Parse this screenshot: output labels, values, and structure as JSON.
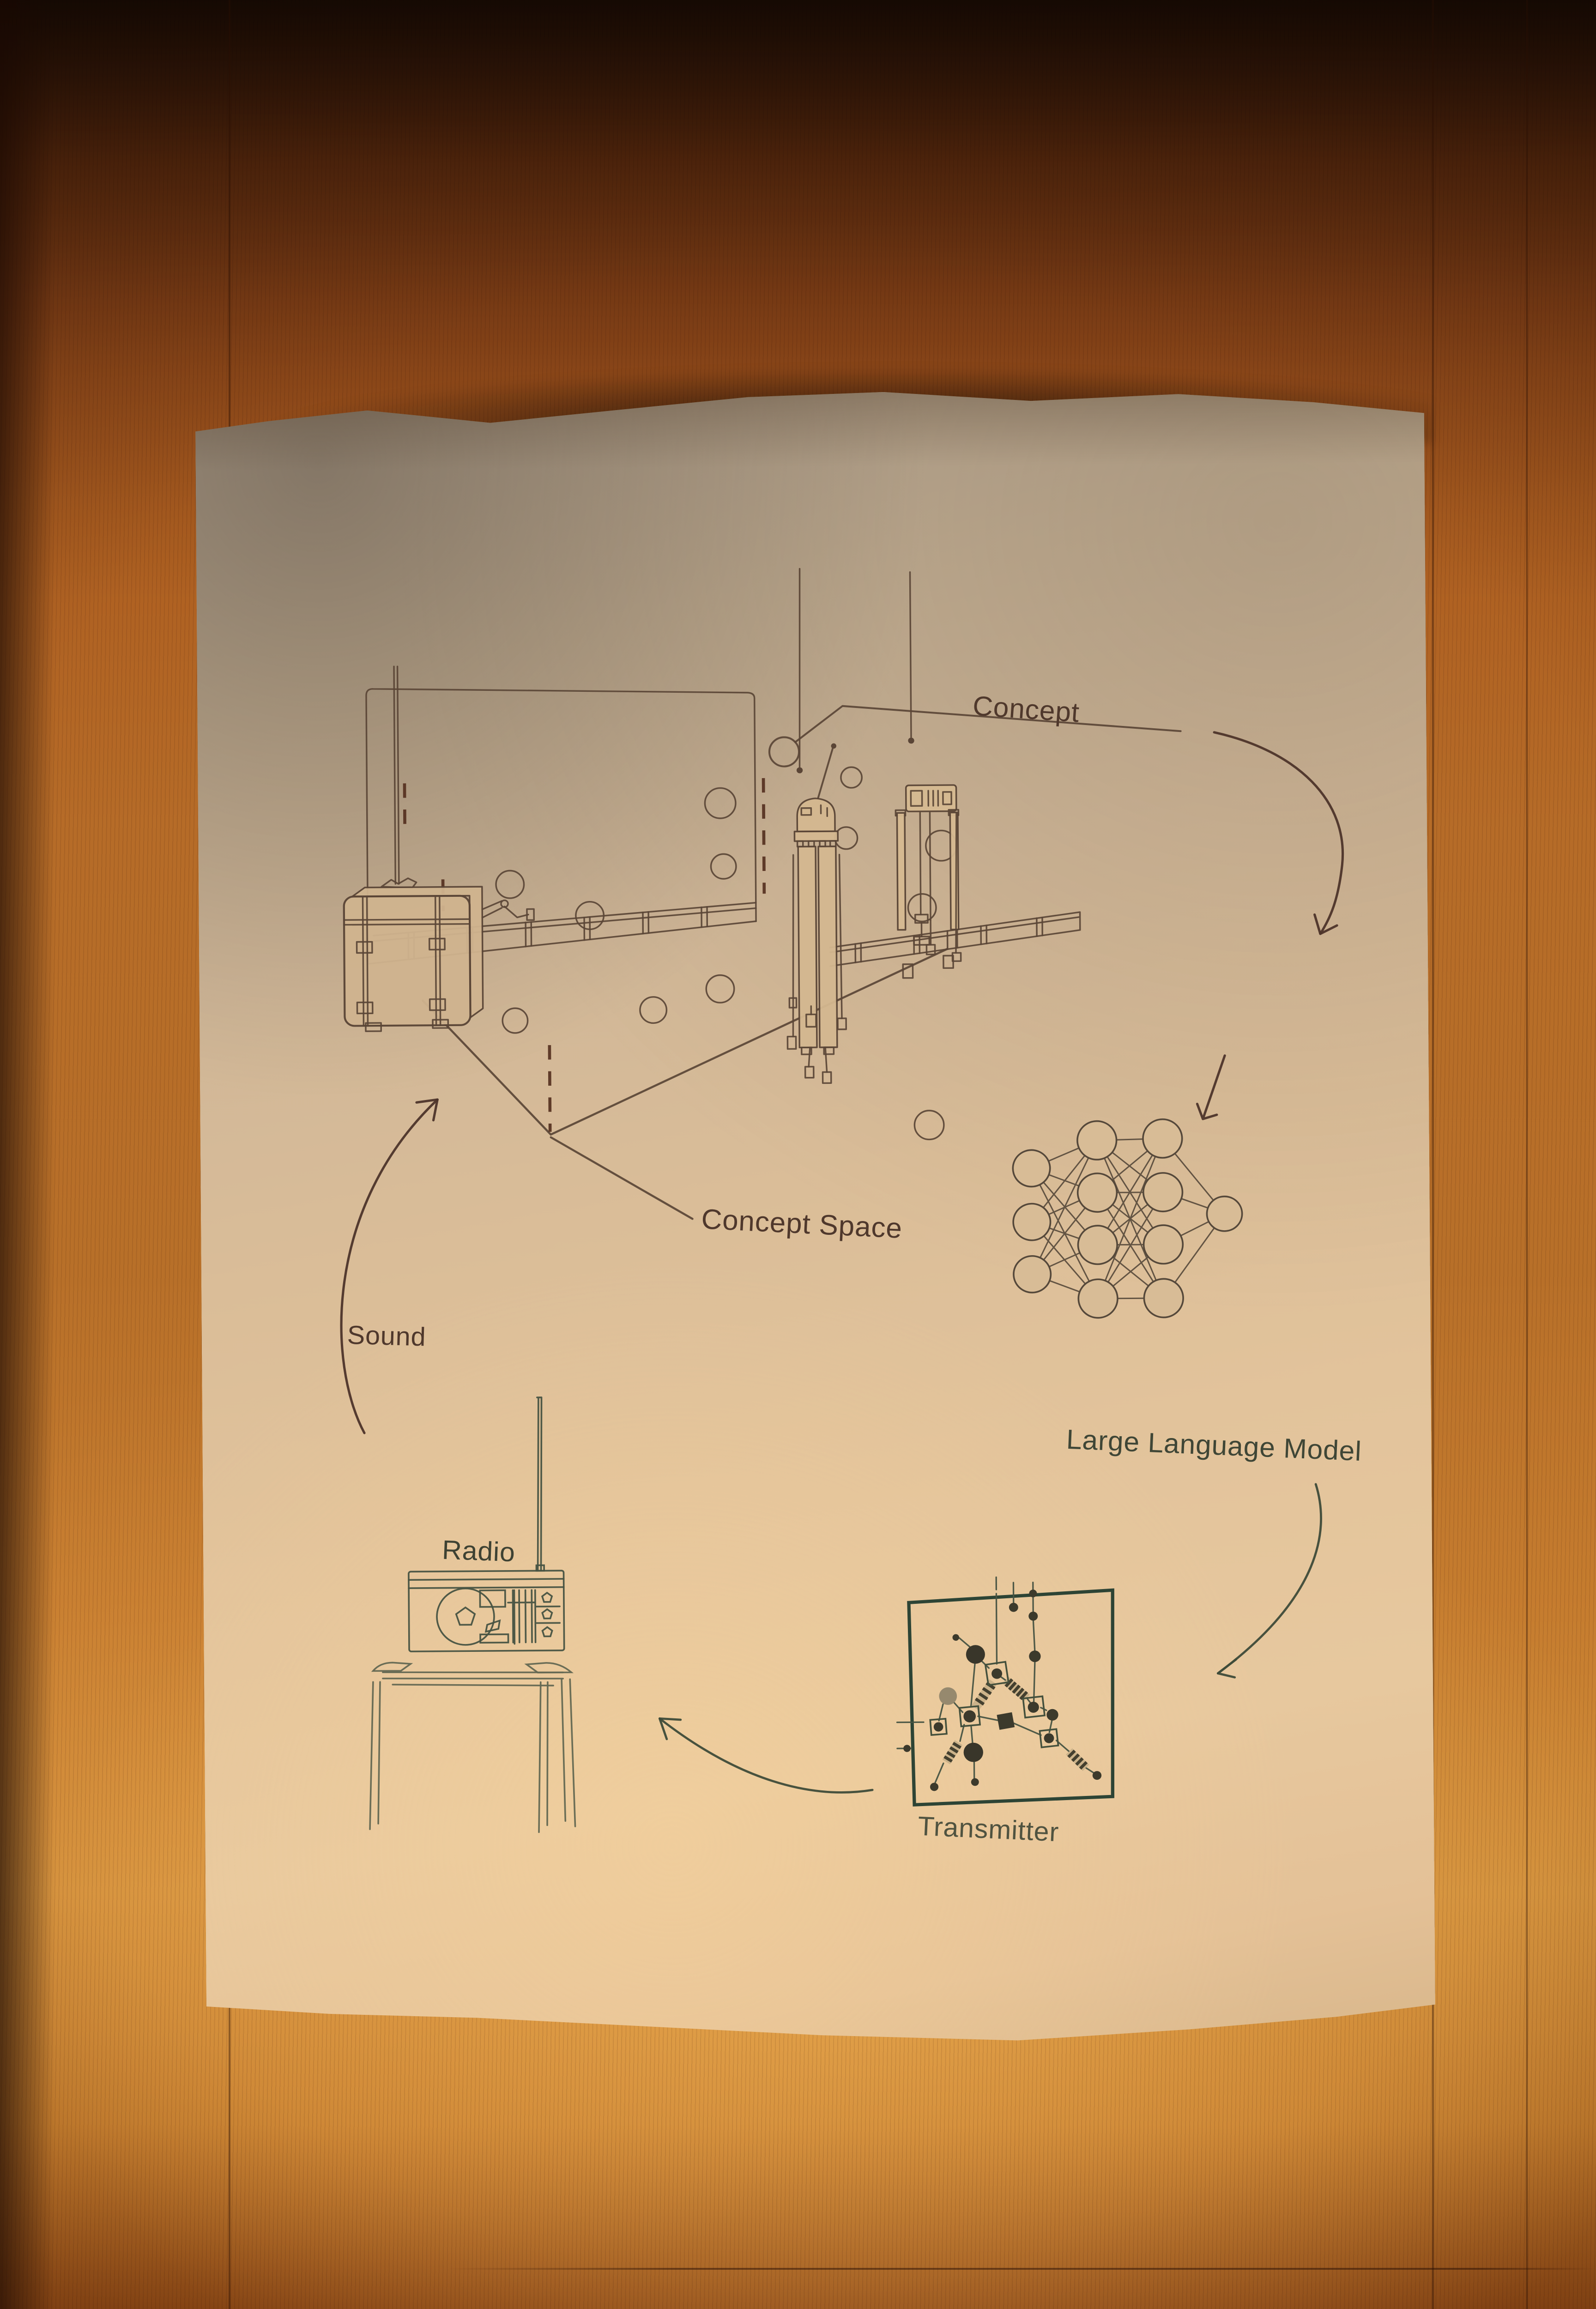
{
  "diagram": {
    "labels": {
      "concept": "Concept",
      "concept_space": "Concept Space",
      "large_language_model": "Large Language Model",
      "transmitter": "Transmitter",
      "radio": "Radio",
      "sound": "Sound"
    },
    "cycle": [
      "Concept Space",
      "Large Language Model",
      "Transmitter",
      "Radio",
      "Sound"
    ],
    "neural_network_layers": [
      3,
      4,
      4,
      1
    ],
    "concept_space": {
      "floating_circles": 12,
      "hanging_cases": 3
    },
    "colors": {
      "ink_brown": "#5a4536",
      "ink_green": "#475342",
      "transmitter_frame": "#2d4435",
      "label_brown": "#4f382c",
      "label_green": "#3f4636",
      "paper": "#dfc29a",
      "wood": "#b06a26"
    }
  }
}
